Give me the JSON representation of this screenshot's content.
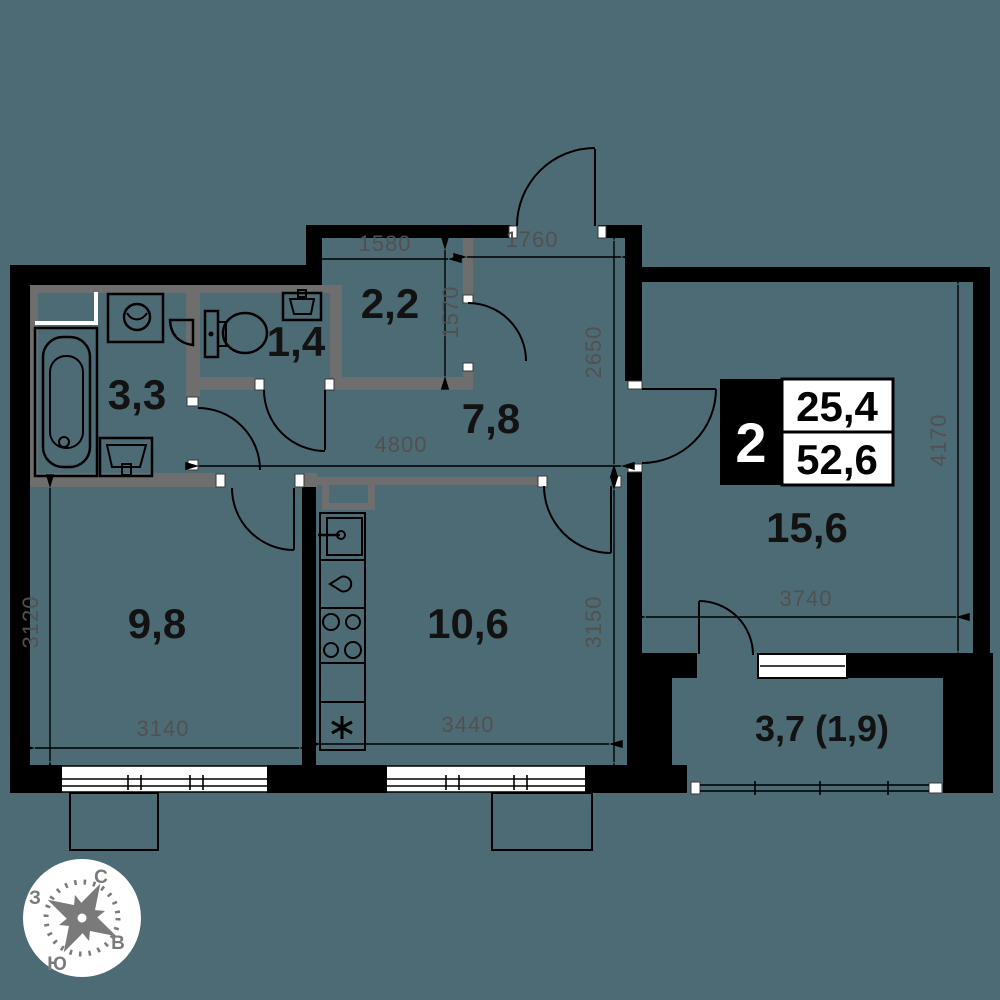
{
  "rooms": {
    "bathroom": "3,3",
    "wc": "1,4",
    "wardrobe": "2,2",
    "hall": "7,8",
    "bedroom": "9,8",
    "kitchen": "10,6",
    "living": "15,6",
    "balcony": "3,7 (1,9)"
  },
  "dimensions": {
    "wardrobe_w": "1580",
    "entry_w": "1760",
    "wardrobe_h": "1570",
    "hall_h": "2650",
    "hall_w": "4800",
    "living_h": "4170",
    "living_w": "3740",
    "kitchen_h": "3150",
    "bedroom_h": "3120",
    "bedroom_w": "3140",
    "kitchen_w": "3440"
  },
  "badge": {
    "room_count": "2",
    "living_area": "25,4",
    "total_area": "52,6"
  },
  "compass": {
    "north": "С",
    "south": "Ю",
    "west": "З",
    "east": "В"
  },
  "colors": {
    "background": "#4D6B74",
    "wall": "#000000",
    "partition": "#6E6E6E",
    "dimension_text": "#515151",
    "compass": "#7a7a7a"
  }
}
